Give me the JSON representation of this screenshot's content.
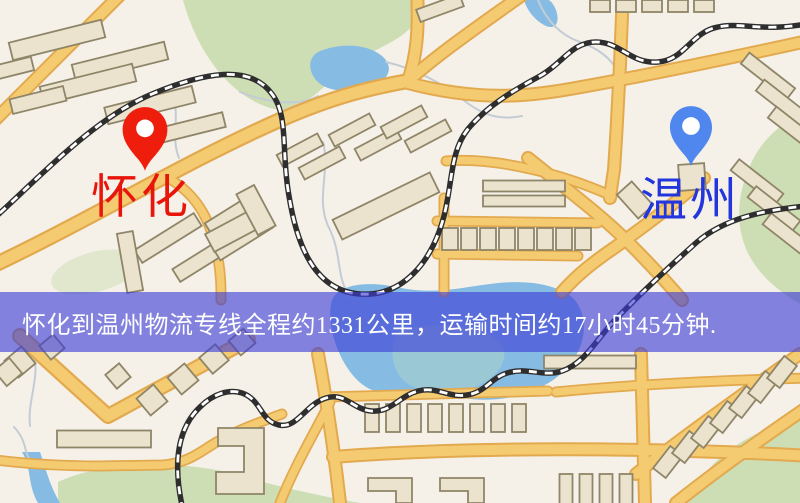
{
  "map": {
    "origin": {
      "name": "怀化",
      "pin": "red-map-pin"
    },
    "destination": {
      "name": "温州",
      "pin": "blue-map-pin"
    },
    "banner": {
      "text": "怀化到温州物流专线全程约1331公里，运输时间约17小时45分钟."
    },
    "route": {
      "distance_text": "约1331公里",
      "duration_text": "约17小时45分钟"
    },
    "colors": {
      "background": "#f5f1e9",
      "road": "#f5cb72",
      "road_casing": "#e2a94e",
      "building": "#ebe3cd",
      "building_outline": "#8f8568",
      "park": "#cddeb5",
      "water": "#86bbe3",
      "water_accent": "#9ecad2",
      "stream": "#c3ccd5",
      "railway": "#2e2e2e",
      "railway_dash": "#ffffff",
      "pin_origin": "#ee1d0c",
      "pin_destination": "#4f87ee",
      "origin_label": "#e8150b",
      "destination_label": "#2336de",
      "banner_bg": "rgba(60,60,214,0.62)",
      "banner_text": "#ffffff"
    }
  }
}
